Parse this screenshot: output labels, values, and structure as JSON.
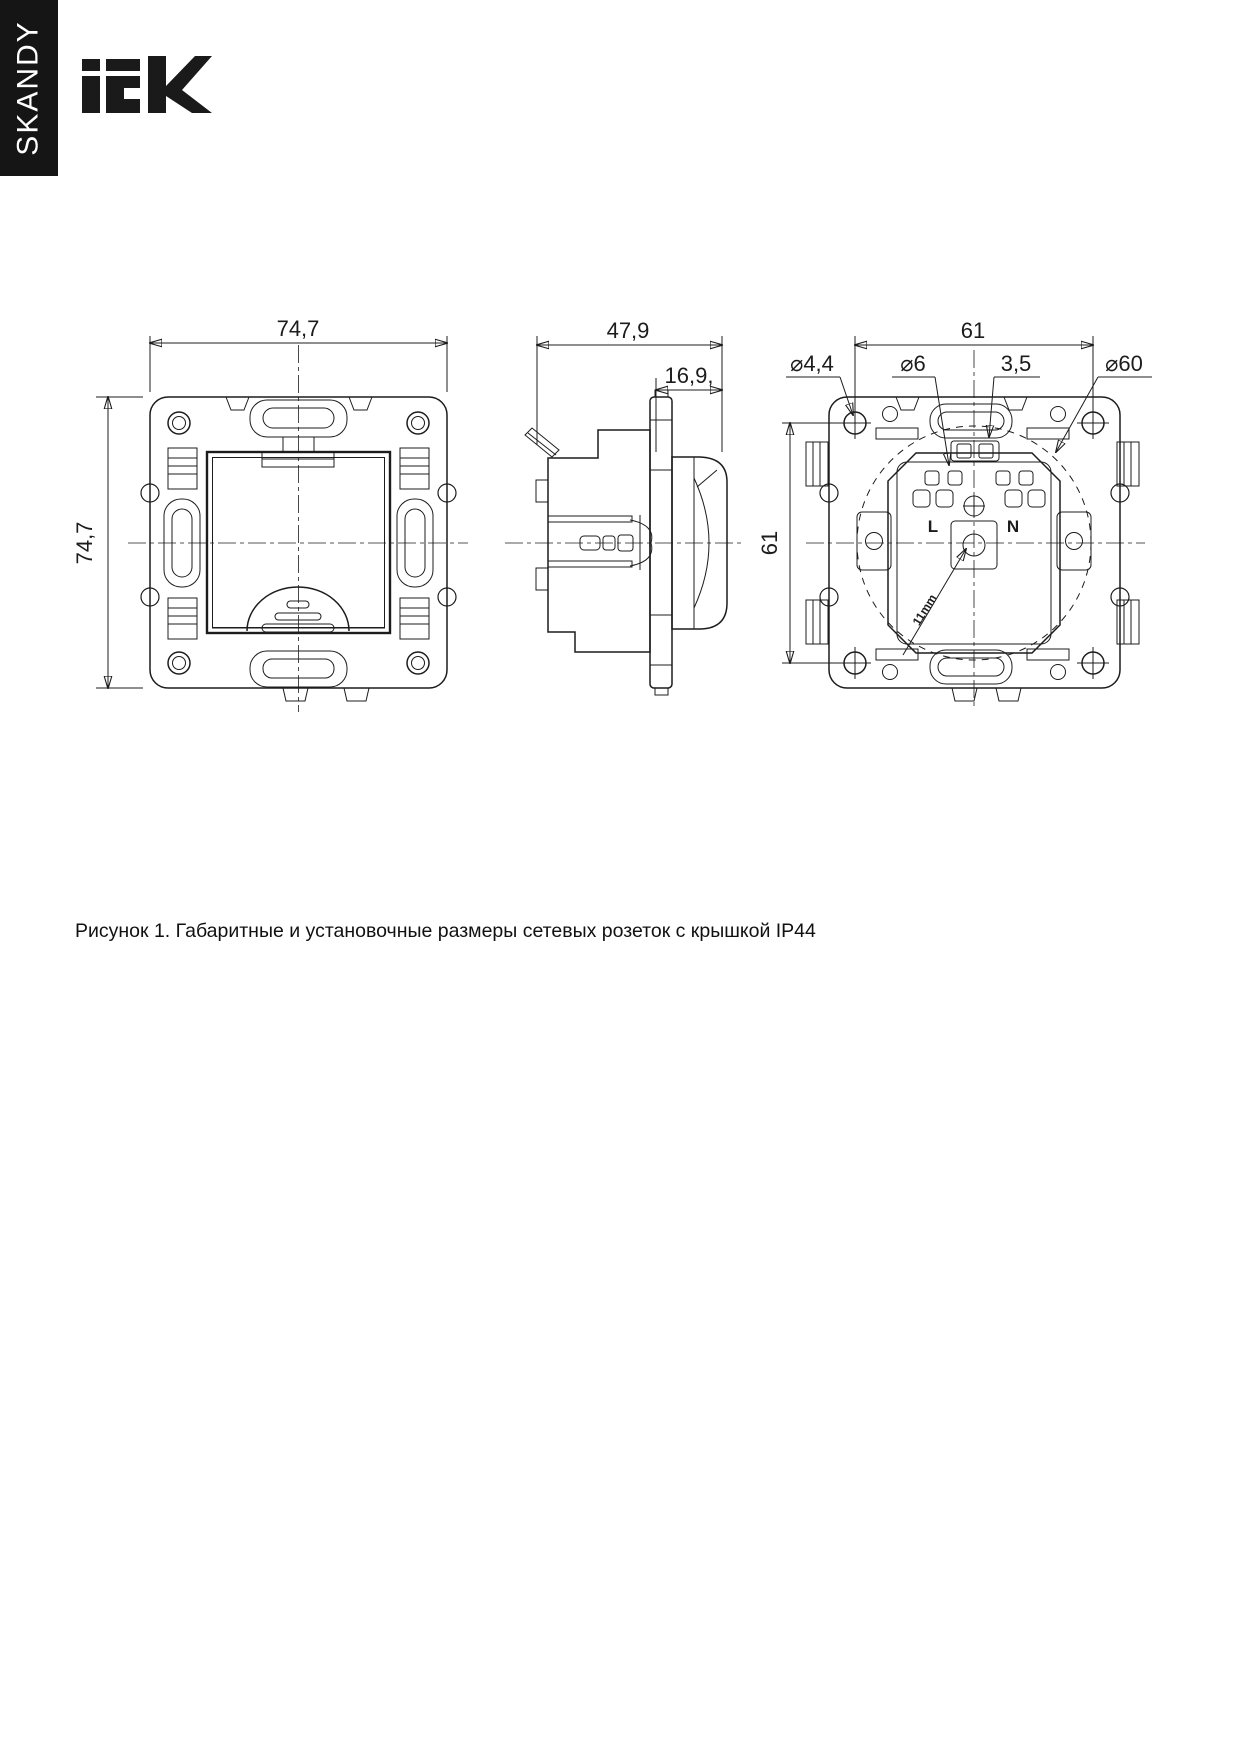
{
  "colors": {
    "line": "#1c1c1c",
    "sidebar_bg": "#151515",
    "page_bg": "#ffffff"
  },
  "sidebar": {
    "label": "SKANDY"
  },
  "brand": {
    "name": "iEK"
  },
  "figure": {
    "caption": "Рисунок 1. Габаритные и установочные размеры сетевых розеток с крышкой IP44",
    "front_view": {
      "width_mm": "74,7",
      "height_mm": "74,7"
    },
    "side_view": {
      "total_depth_mm": "47,9",
      "front_depth_mm": "16,9,"
    },
    "rear_view": {
      "mount_hole_spacing_h_mm": "61",
      "mount_hole_spacing_v_mm": "61",
      "fixing_hole_d": "⌀4,4",
      "terminal_hole_d": "⌀6",
      "screw": "3,5",
      "mounting_box_d": "⌀60",
      "label_line": "L",
      "label_neutral": "N",
      "wire_strip_length": "11mm"
    }
  }
}
